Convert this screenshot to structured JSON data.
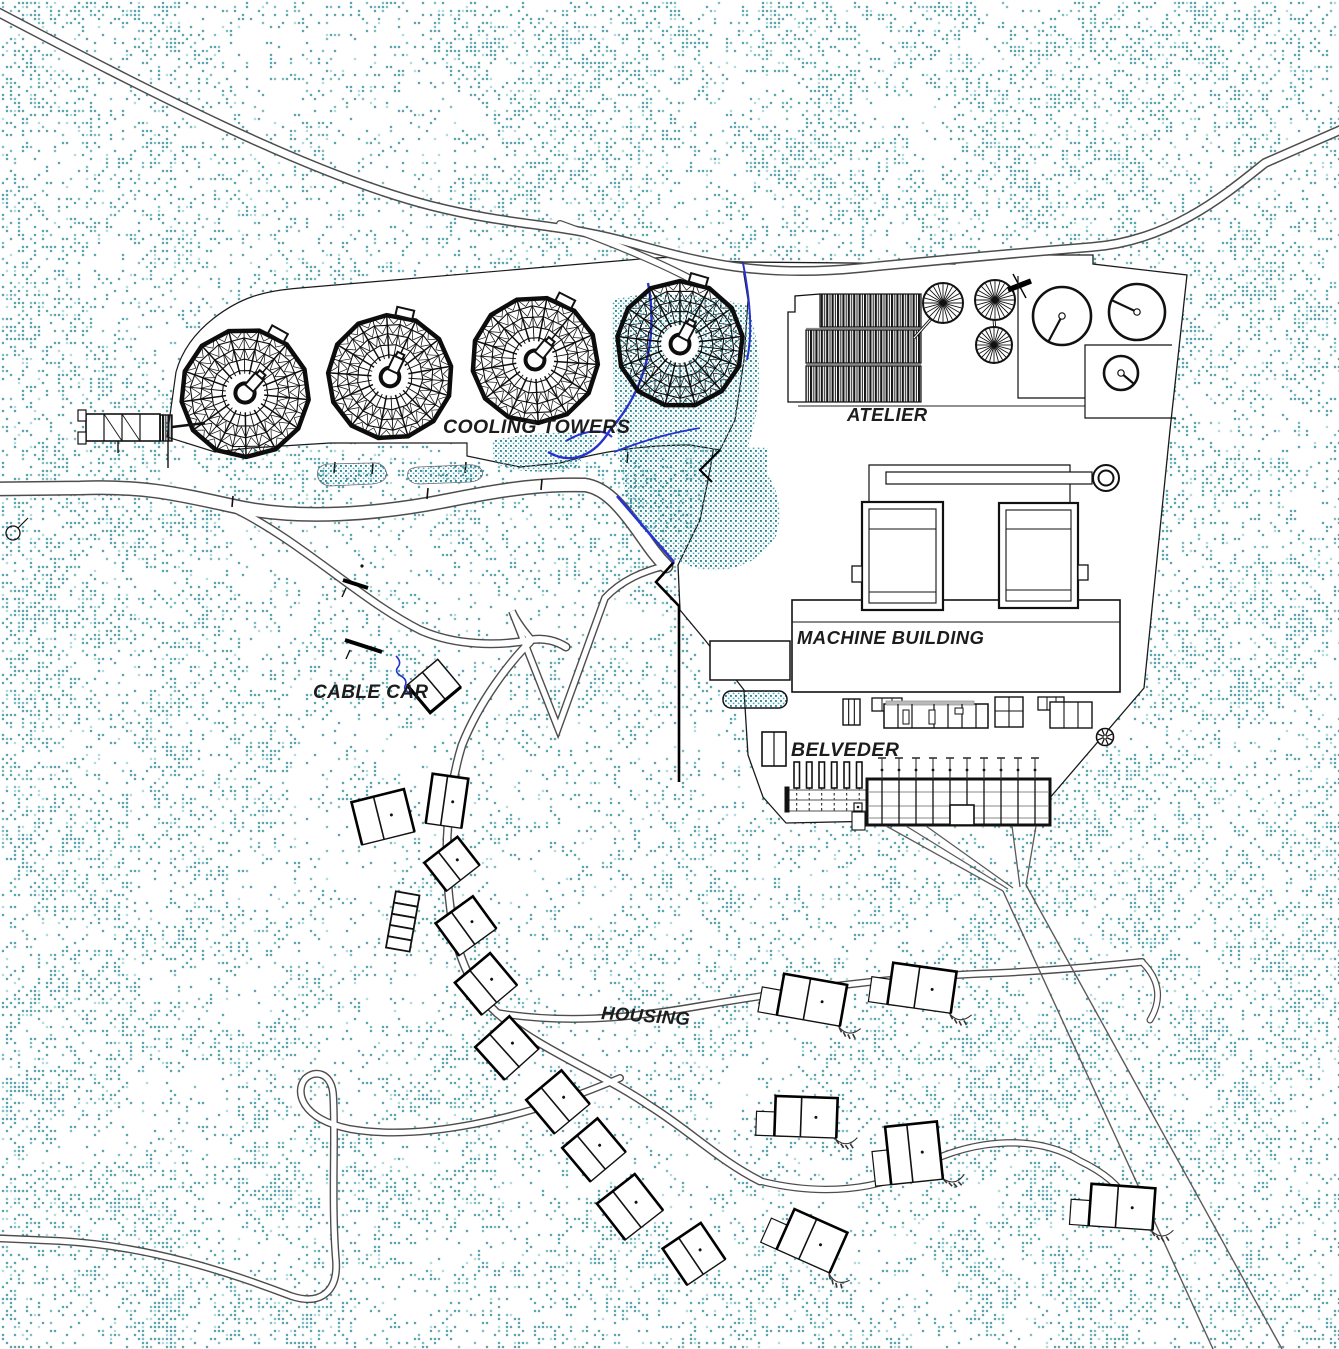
{
  "plan": {
    "type": "architectural-site-plan",
    "labels": {
      "cooling_towers": "COOLING TOWERS",
      "atelier": "ATELIER",
      "machine_building": "MACHINE BUILDING",
      "cable_car": "CABLE CAR",
      "belveder": "BELVEDER",
      "housing": "HOUSING"
    },
    "features": {
      "cooling_towers_count": 4,
      "ventilation_fans_count": 3,
      "storage_tanks_count": 3,
      "houses_count": 16,
      "transmission_lines_count": 2
    },
    "colors": {
      "background": "#ffffff",
      "terrain_stipple": "#2a8a96",
      "terrain_stipple_mid": "#57a7b0",
      "terrain_stipple_light": "#9ccfd4",
      "water_line": "#2633cc",
      "road_casing": "#4d4d4d",
      "building_line": "#111111",
      "label_text": "#1c1c1c"
    }
  }
}
